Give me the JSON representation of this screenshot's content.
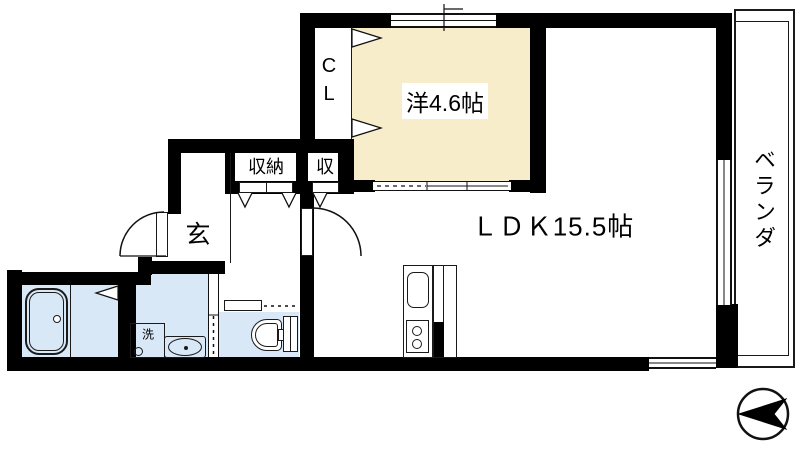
{
  "plan": {
    "bedroom_label": "洋4.6帖",
    "ldk_label": "ＬＤＫ15.5帖",
    "veranda_label": "ベランダ",
    "entrance_label": "玄",
    "closet_label": "CL",
    "storage_large_label": "収納",
    "storage_small_label": "収",
    "washer_label": "洗"
  },
  "colors": {
    "wall": "#000000",
    "line": "#1a1a1a",
    "background": "#ffffff",
    "bedroom_floor": "#f8edca",
    "wet_area_floor": "#d9e8f7"
  }
}
